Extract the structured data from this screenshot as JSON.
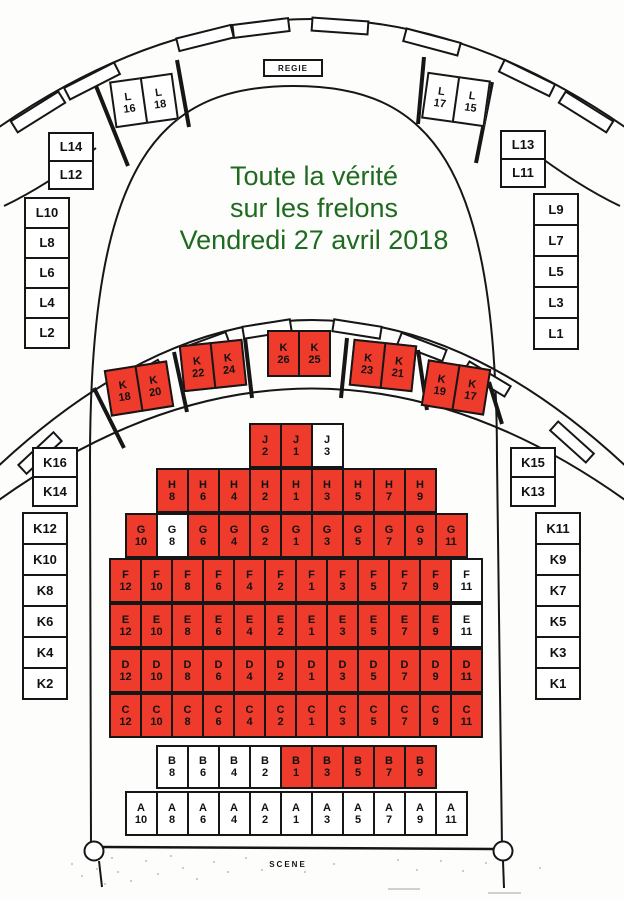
{
  "title": {
    "lines": [
      "Toute la vérité",
      "sur les frelons",
      "Vendredi 27 avril 2018"
    ]
  },
  "colors": {
    "occupied_red": "#ef3b2c",
    "available_white": "#ffffff",
    "ink": "#161616",
    "title_green": "#1e6b20"
  },
  "upper_balcony": {
    "regie_label": "REGIE",
    "pairs": [
      {
        "seats": [
          {
            "r": "L",
            "n": "16",
            "occ": false
          },
          {
            "r": "L",
            "n": "18",
            "occ": false
          }
        ]
      },
      {
        "seats": [
          {
            "r": "L",
            "n": "17",
            "occ": false
          },
          {
            "r": "L",
            "n": "15",
            "occ": false
          }
        ]
      }
    ],
    "left_stack": [
      {
        "label": "L14",
        "occ": false
      },
      {
        "label": "L12",
        "occ": false
      }
    ],
    "right_stack": [
      {
        "label": "L13",
        "occ": false
      },
      {
        "label": "L11",
        "occ": false
      }
    ],
    "left_column": [
      {
        "label": "L10",
        "occ": false
      },
      {
        "label": "L8",
        "occ": false
      },
      {
        "label": "L6",
        "occ": false
      },
      {
        "label": "L4",
        "occ": false
      },
      {
        "label": "L2",
        "occ": false
      }
    ],
    "right_column": [
      {
        "label": "L9",
        "occ": false
      },
      {
        "label": "L7",
        "occ": false
      },
      {
        "label": "L5",
        "occ": false
      },
      {
        "label": "L3",
        "occ": false
      },
      {
        "label": "L1",
        "occ": false
      }
    ]
  },
  "lower_balcony": {
    "pairs": [
      {
        "seats": [
          {
            "r": "K",
            "n": "18",
            "occ": true
          },
          {
            "r": "K",
            "n": "20",
            "occ": true
          }
        ]
      },
      {
        "seats": [
          {
            "r": "K",
            "n": "22",
            "occ": true
          },
          {
            "r": "K",
            "n": "24",
            "occ": true
          }
        ]
      },
      {
        "seats": [
          {
            "r": "K",
            "n": "26",
            "occ": true
          },
          {
            "r": "K",
            "n": "25",
            "occ": true
          }
        ]
      },
      {
        "seats": [
          {
            "r": "K",
            "n": "23",
            "occ": true
          },
          {
            "r": "K",
            "n": "21",
            "occ": true
          }
        ]
      },
      {
        "seats": [
          {
            "r": "K",
            "n": "19",
            "occ": true
          },
          {
            "r": "K",
            "n": "17",
            "occ": true
          }
        ]
      }
    ],
    "left_stack": [
      {
        "label": "K16",
        "occ": false
      },
      {
        "label": "K14",
        "occ": false
      }
    ],
    "right_stack": [
      {
        "label": "K15",
        "occ": false
      },
      {
        "label": "K13",
        "occ": false
      }
    ],
    "left_column": [
      {
        "label": "K12",
        "occ": false
      },
      {
        "label": "K10",
        "occ": false
      },
      {
        "label": "K8",
        "occ": false
      },
      {
        "label": "K6",
        "occ": false
      },
      {
        "label": "K4",
        "occ": false
      },
      {
        "label": "K2",
        "occ": false
      }
    ],
    "right_column": [
      {
        "label": "K11",
        "occ": false
      },
      {
        "label": "K9",
        "occ": false
      },
      {
        "label": "K7",
        "occ": false
      },
      {
        "label": "K5",
        "occ": false
      },
      {
        "label": "K3",
        "occ": false
      },
      {
        "label": "K1",
        "occ": false
      }
    ]
  },
  "floor": {
    "rows": [
      {
        "name": "J",
        "seats": [
          {
            "r": "J",
            "n": "2",
            "occ": true
          },
          {
            "r": "J",
            "n": "1",
            "occ": true
          },
          {
            "r": "J",
            "n": "3",
            "occ": false
          }
        ]
      },
      {
        "name": "H",
        "seats": [
          {
            "r": "H",
            "n": "8",
            "occ": true
          },
          {
            "r": "H",
            "n": "6",
            "occ": true
          },
          {
            "r": "H",
            "n": "4",
            "occ": true
          },
          {
            "r": "H",
            "n": "2",
            "occ": true
          },
          {
            "r": "H",
            "n": "1",
            "occ": true
          },
          {
            "r": "H",
            "n": "3",
            "occ": true
          },
          {
            "r": "H",
            "n": "5",
            "occ": true
          },
          {
            "r": "H",
            "n": "7",
            "occ": true
          },
          {
            "r": "H",
            "n": "9",
            "occ": true
          }
        ]
      },
      {
        "name": "G",
        "seats": [
          {
            "r": "G",
            "n": "10",
            "occ": true
          },
          {
            "r": "G",
            "n": "8",
            "occ": false
          },
          {
            "r": "G",
            "n": "6",
            "occ": true
          },
          {
            "r": "G",
            "n": "4",
            "occ": true
          },
          {
            "r": "G",
            "n": "2",
            "occ": true
          },
          {
            "r": "G",
            "n": "1",
            "occ": true
          },
          {
            "r": "G",
            "n": "3",
            "occ": true
          },
          {
            "r": "G",
            "n": "5",
            "occ": true
          },
          {
            "r": "G",
            "n": "7",
            "occ": true
          },
          {
            "r": "G",
            "n": "9",
            "occ": true
          },
          {
            "r": "G",
            "n": "11",
            "occ": true
          }
        ]
      },
      {
        "name": "F",
        "seats": [
          {
            "r": "F",
            "n": "12",
            "occ": true
          },
          {
            "r": "F",
            "n": "10",
            "occ": true
          },
          {
            "r": "F",
            "n": "8",
            "occ": true
          },
          {
            "r": "F",
            "n": "6",
            "occ": true
          },
          {
            "r": "F",
            "n": "4",
            "occ": true
          },
          {
            "r": "F",
            "n": "2",
            "occ": true
          },
          {
            "r": "F",
            "n": "1",
            "occ": true
          },
          {
            "r": "F",
            "n": "3",
            "occ": true
          },
          {
            "r": "F",
            "n": "5",
            "occ": true
          },
          {
            "r": "F",
            "n": "7",
            "occ": true
          },
          {
            "r": "F",
            "n": "9",
            "occ": true
          },
          {
            "r": "F",
            "n": "11",
            "occ": false
          }
        ]
      },
      {
        "name": "E",
        "seats": [
          {
            "r": "E",
            "n": "12",
            "occ": true
          },
          {
            "r": "E",
            "n": "10",
            "occ": true
          },
          {
            "r": "E",
            "n": "8",
            "occ": true
          },
          {
            "r": "E",
            "n": "6",
            "occ": true
          },
          {
            "r": "E",
            "n": "4",
            "occ": true
          },
          {
            "r": "E",
            "n": "2",
            "occ": true
          },
          {
            "r": "E",
            "n": "1",
            "occ": true
          },
          {
            "r": "E",
            "n": "3",
            "occ": true
          },
          {
            "r": "E",
            "n": "5",
            "occ": true
          },
          {
            "r": "E",
            "n": "7",
            "occ": true
          },
          {
            "r": "E",
            "n": "9",
            "occ": true
          },
          {
            "r": "E",
            "n": "11",
            "occ": false
          }
        ]
      },
      {
        "name": "D",
        "seats": [
          {
            "r": "D",
            "n": "12",
            "occ": true
          },
          {
            "r": "D",
            "n": "10",
            "occ": true
          },
          {
            "r": "D",
            "n": "8",
            "occ": true
          },
          {
            "r": "D",
            "n": "6",
            "occ": true
          },
          {
            "r": "D",
            "n": "4",
            "occ": true
          },
          {
            "r": "D",
            "n": "2",
            "occ": true
          },
          {
            "r": "D",
            "n": "1",
            "occ": true
          },
          {
            "r": "D",
            "n": "3",
            "occ": true
          },
          {
            "r": "D",
            "n": "5",
            "occ": true
          },
          {
            "r": "D",
            "n": "7",
            "occ": true
          },
          {
            "r": "D",
            "n": "9",
            "occ": true
          },
          {
            "r": "D",
            "n": "11",
            "occ": true
          }
        ]
      },
      {
        "name": "C",
        "seats": [
          {
            "r": "C",
            "n": "12",
            "occ": true
          },
          {
            "r": "C",
            "n": "10",
            "occ": true
          },
          {
            "r": "C",
            "n": "8",
            "occ": true
          },
          {
            "r": "C",
            "n": "6",
            "occ": true
          },
          {
            "r": "C",
            "n": "4",
            "occ": true
          },
          {
            "r": "C",
            "n": "2",
            "occ": true
          },
          {
            "r": "C",
            "n": "1",
            "occ": true
          },
          {
            "r": "C",
            "n": "3",
            "occ": true
          },
          {
            "r": "C",
            "n": "5",
            "occ": true
          },
          {
            "r": "C",
            "n": "7",
            "occ": true
          },
          {
            "r": "C",
            "n": "9",
            "occ": true
          },
          {
            "r": "C",
            "n": "11",
            "occ": true
          }
        ]
      },
      {
        "name": "B",
        "seats": [
          {
            "r": "B",
            "n": "8",
            "occ": false
          },
          {
            "r": "B",
            "n": "6",
            "occ": false
          },
          {
            "r": "B",
            "n": "4",
            "occ": false
          },
          {
            "r": "B",
            "n": "2",
            "occ": false
          },
          {
            "r": "B",
            "n": "1",
            "occ": true
          },
          {
            "r": "B",
            "n": "3",
            "occ": true
          },
          {
            "r": "B",
            "n": "5",
            "occ": true
          },
          {
            "r": "B",
            "n": "7",
            "occ": true
          },
          {
            "r": "B",
            "n": "9",
            "occ": true
          }
        ]
      },
      {
        "name": "A",
        "seats": [
          {
            "r": "A",
            "n": "10",
            "occ": false
          },
          {
            "r": "A",
            "n": "8",
            "occ": false
          },
          {
            "r": "A",
            "n": "6",
            "occ": false
          },
          {
            "r": "A",
            "n": "4",
            "occ": false
          },
          {
            "r": "A",
            "n": "2",
            "occ": false
          },
          {
            "r": "A",
            "n": "1",
            "occ": false
          },
          {
            "r": "A",
            "n": "3",
            "occ": false
          },
          {
            "r": "A",
            "n": "5",
            "occ": false
          },
          {
            "r": "A",
            "n": "7",
            "occ": false
          },
          {
            "r": "A",
            "n": "9",
            "occ": false
          },
          {
            "r": "A",
            "n": "11",
            "occ": false
          }
        ]
      }
    ]
  },
  "stage": {
    "label": "SCENE"
  }
}
